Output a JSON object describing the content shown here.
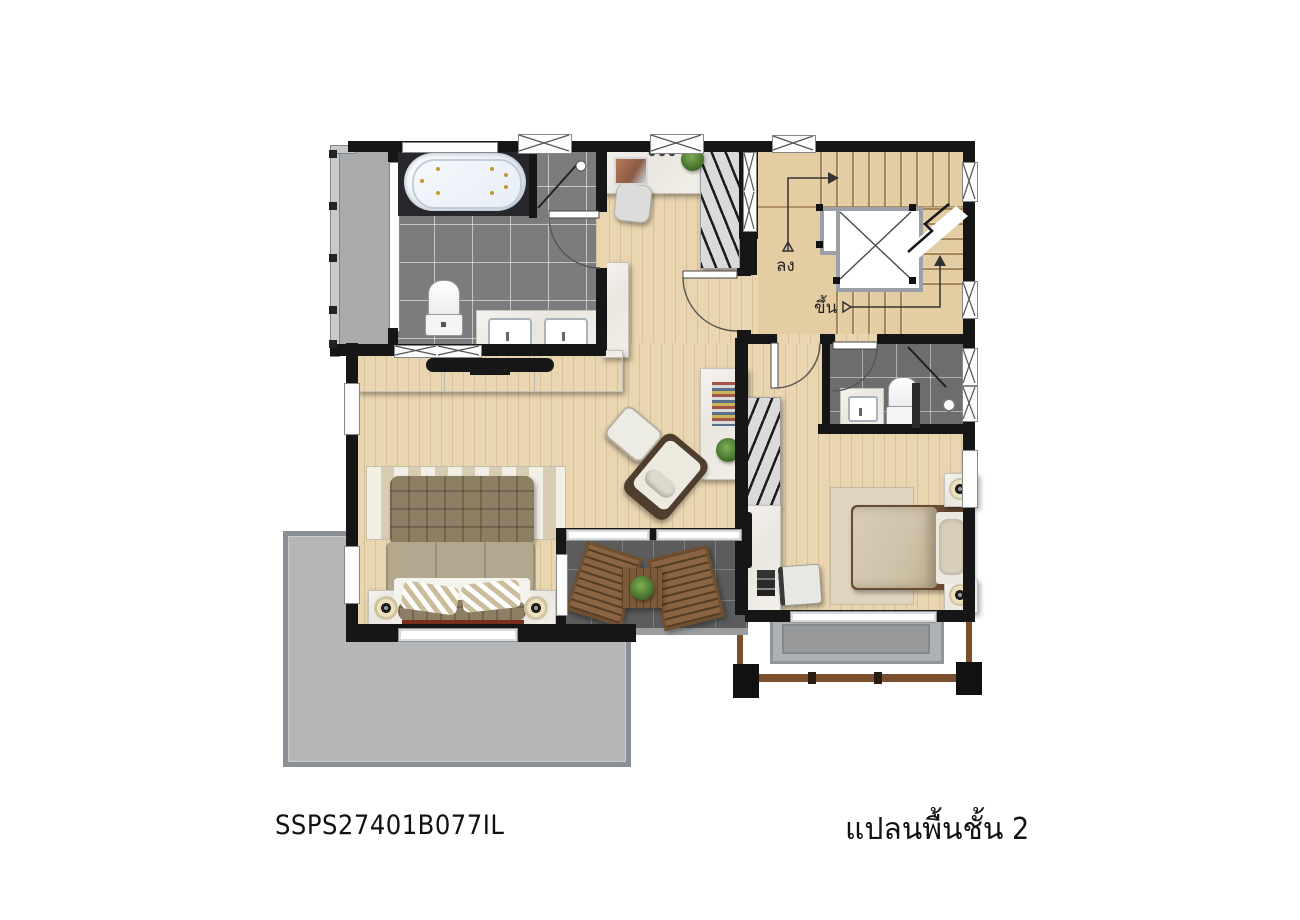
{
  "title": {
    "plan_code": "SSPS27401B077IL",
    "plan_title": "แปลนพื้นชั้น 2"
  },
  "stair_labels": {
    "down": "ลง",
    "up": "ขึ้น"
  },
  "palette": {
    "wall": "#161616",
    "wood_floor": "#e9d6b0",
    "bathroom_tile": "#7c7c7c",
    "balcony_tile": "#5c5c5c",
    "terrace_concrete": "#b4b6b8",
    "marble_counter": "#f1efe9",
    "outdoor_wood": "#8a6442",
    "bed_bench_accent": "#792f1b"
  }
}
